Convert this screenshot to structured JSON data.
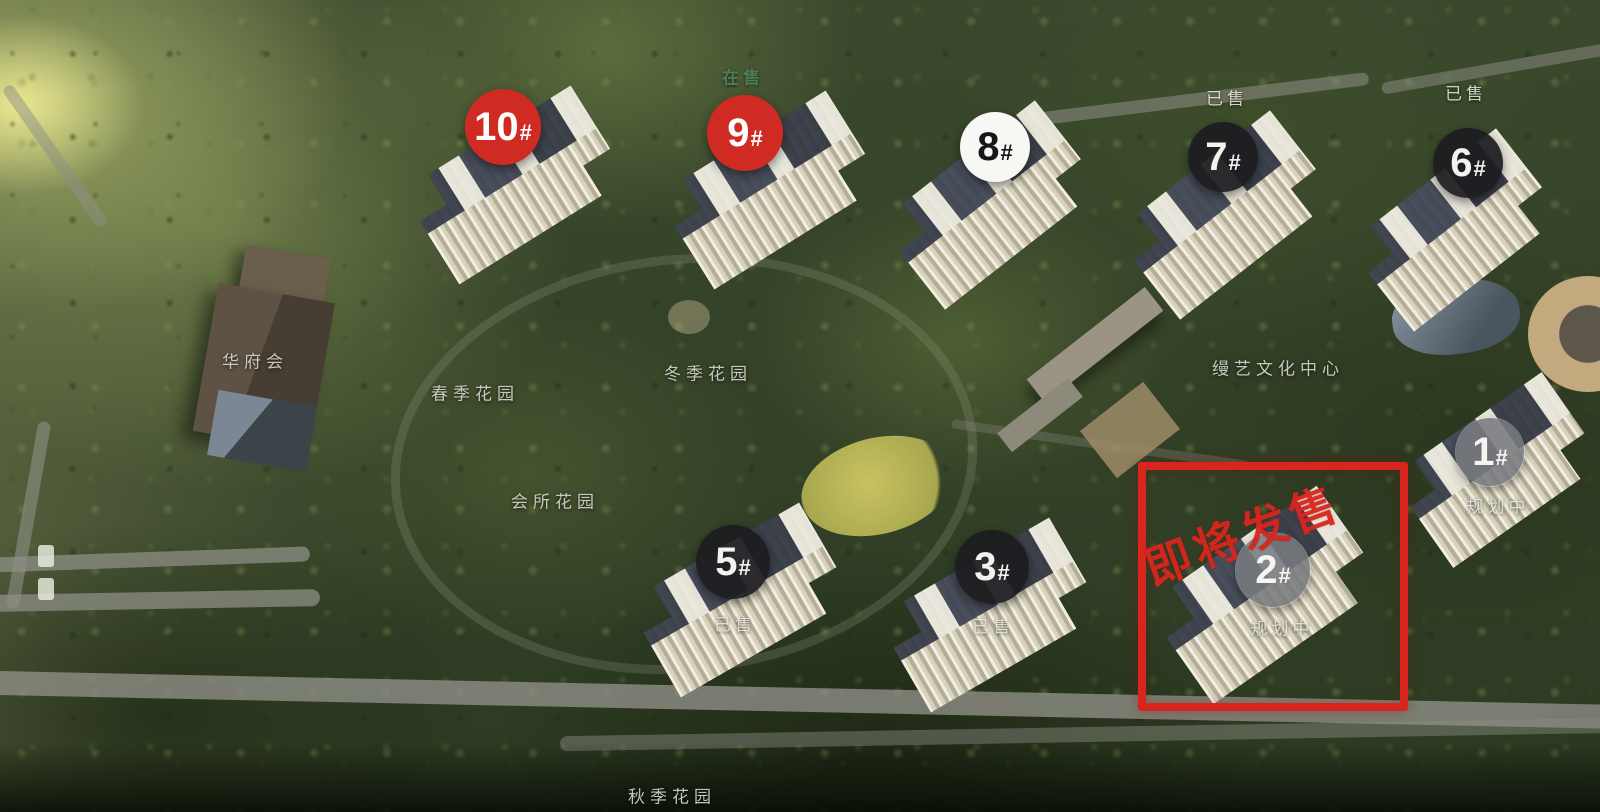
{
  "marker_styles": {
    "red": {
      "bg": "#d02b23",
      "fg": "#ffffff"
    },
    "white": {
      "bg": "#f7f7f4",
      "fg": "#161619"
    },
    "dark": {
      "bg": "rgba(28,28,32,0.93)",
      "fg": "#f2f2ee"
    },
    "gray": {
      "bg": "rgba(120,122,126,0.88)",
      "fg": "#f5f5f1"
    }
  },
  "markers": [
    {
      "num": "10",
      "suffix": "#",
      "style": "red",
      "x": 503,
      "y": 127,
      "r": 38
    },
    {
      "num": "9",
      "suffix": "#",
      "style": "red",
      "x": 745,
      "y": 133,
      "r": 38
    },
    {
      "num": "8",
      "suffix": "#",
      "style": "white",
      "x": 995,
      "y": 147,
      "r": 35
    },
    {
      "num": "7",
      "suffix": "#",
      "style": "dark",
      "x": 1223,
      "y": 157,
      "r": 35
    },
    {
      "num": "6",
      "suffix": "#",
      "style": "dark",
      "x": 1468,
      "y": 163,
      "r": 35
    },
    {
      "num": "5",
      "suffix": "#",
      "style": "dark",
      "x": 733,
      "y": 562,
      "r": 37
    },
    {
      "num": "3",
      "suffix": "#",
      "style": "dark",
      "x": 992,
      "y": 567,
      "r": 37
    },
    {
      "num": "2",
      "suffix": "#",
      "style": "gray",
      "x": 1273,
      "y": 570,
      "r": 37
    },
    {
      "num": "1",
      "suffix": "#",
      "style": "gray",
      "x": 1490,
      "y": 452,
      "r": 34
    }
  ],
  "status_labels": [
    {
      "text": "在售",
      "variant": "onsale",
      "x": 743,
      "y": 76
    },
    {
      "text": "已售",
      "variant": "sold",
      "x": 1227,
      "y": 97
    },
    {
      "text": "已售",
      "variant": "sold",
      "x": 1466,
      "y": 92
    },
    {
      "text": "已售",
      "variant": "sold",
      "x": 735,
      "y": 623
    },
    {
      "text": "已售",
      "variant": "sold",
      "x": 993,
      "y": 625
    },
    {
      "text": "规划中",
      "variant": "planning",
      "x": 1282,
      "y": 627
    },
    {
      "text": "规划中",
      "variant": "planning",
      "x": 1498,
      "y": 505
    }
  ],
  "area_labels": [
    {
      "text": "华府会",
      "x": 255,
      "y": 360
    },
    {
      "text": "春季花园",
      "x": 475,
      "y": 392
    },
    {
      "text": "冬季花园",
      "x": 708,
      "y": 372
    },
    {
      "text": "会所花园",
      "x": 555,
      "y": 500
    },
    {
      "text": "秋季花园",
      "x": 672,
      "y": 795
    },
    {
      "text": "缦艺文化中心",
      "x": 1278,
      "y": 367
    }
  ],
  "highlight": {
    "text": "即将发售",
    "color": "#d8251d",
    "border_width": 8,
    "box": {
      "x": 1138,
      "y": 462,
      "w": 254,
      "h": 233
    },
    "banner": {
      "x": 1122,
      "y": 500
    }
  }
}
